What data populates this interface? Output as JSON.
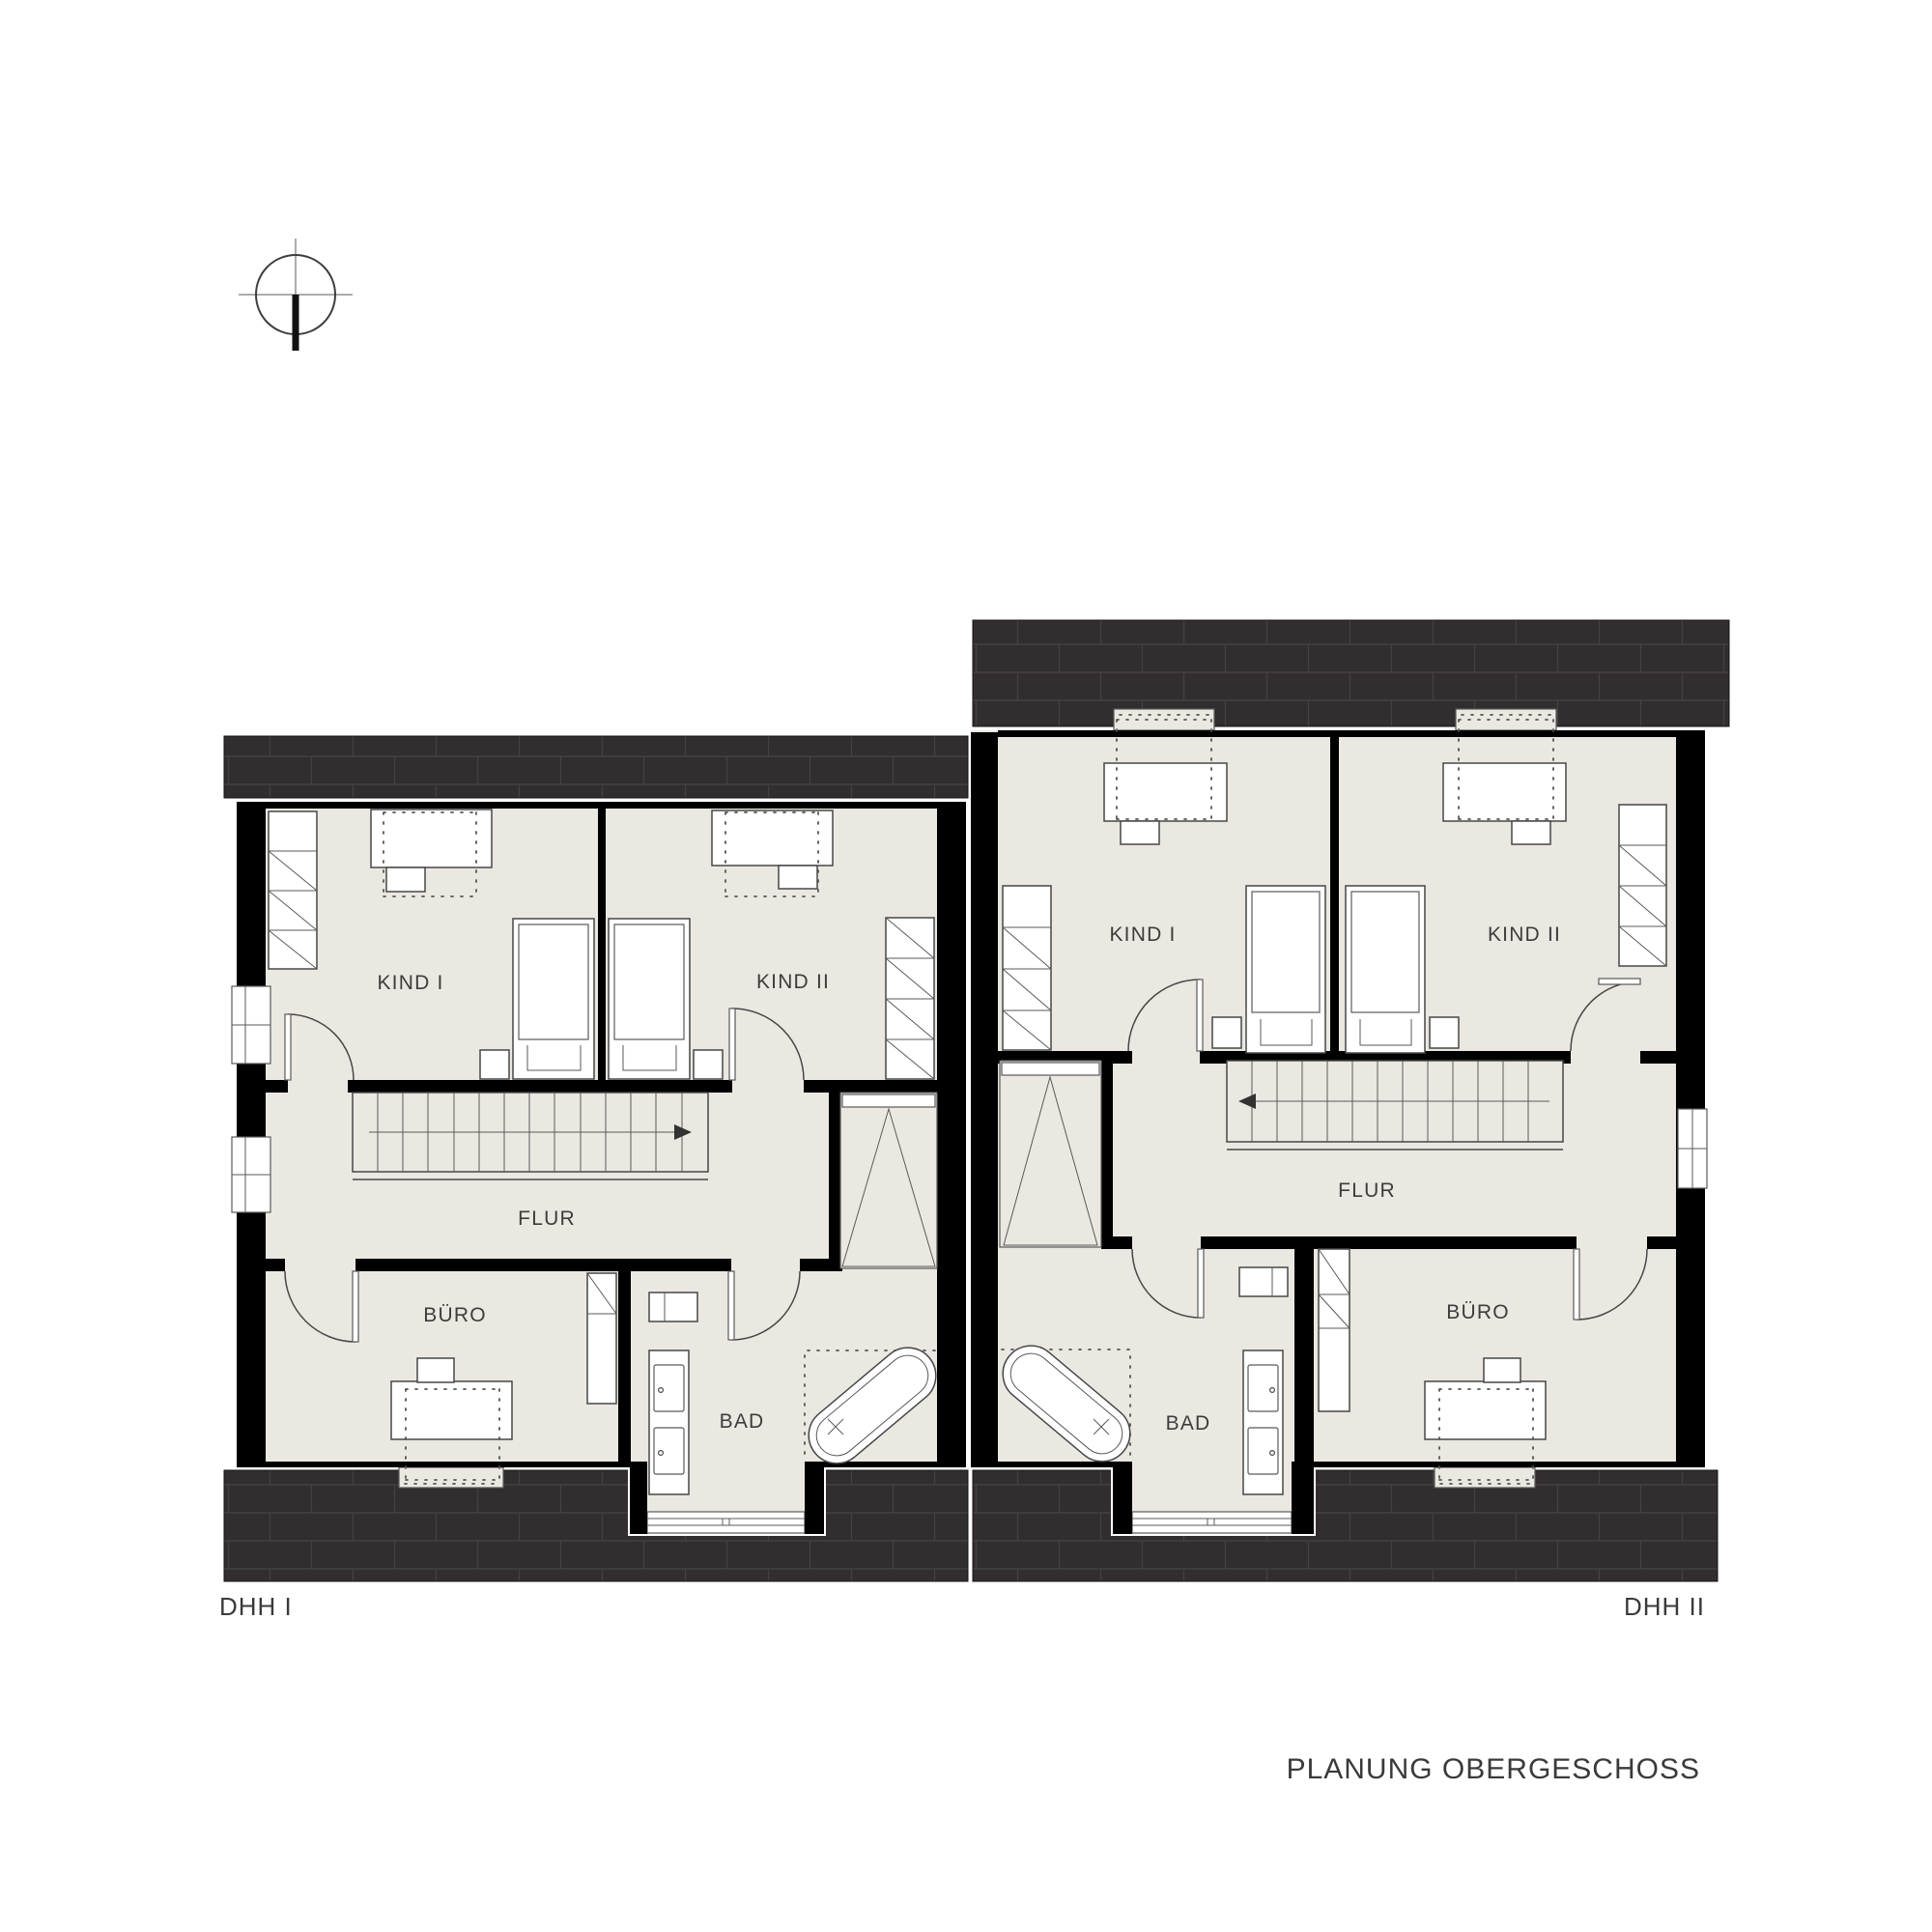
{
  "plan": {
    "title": "PLANUNG OBERGESCHOSS",
    "units": {
      "dhh1": {
        "name": "DHH I",
        "rooms": {
          "kind1": "KIND I",
          "kind2": "KIND II",
          "flur": "FLUR",
          "buero": "BÜRO",
          "bad": "BAD"
        }
      },
      "dhh2": {
        "name": "DHH II",
        "rooms": {
          "kind1": "KIND I",
          "kind2": "KIND II",
          "flur": "FLUR",
          "buero": "BÜRO",
          "bad": "BAD"
        }
      }
    },
    "colors": {
      "floor": "#eae8e1",
      "roof": "#322d2e",
      "wall": "#000000",
      "stroke": "#474747"
    },
    "icons": {
      "north": "north-orientation-icon"
    }
  }
}
